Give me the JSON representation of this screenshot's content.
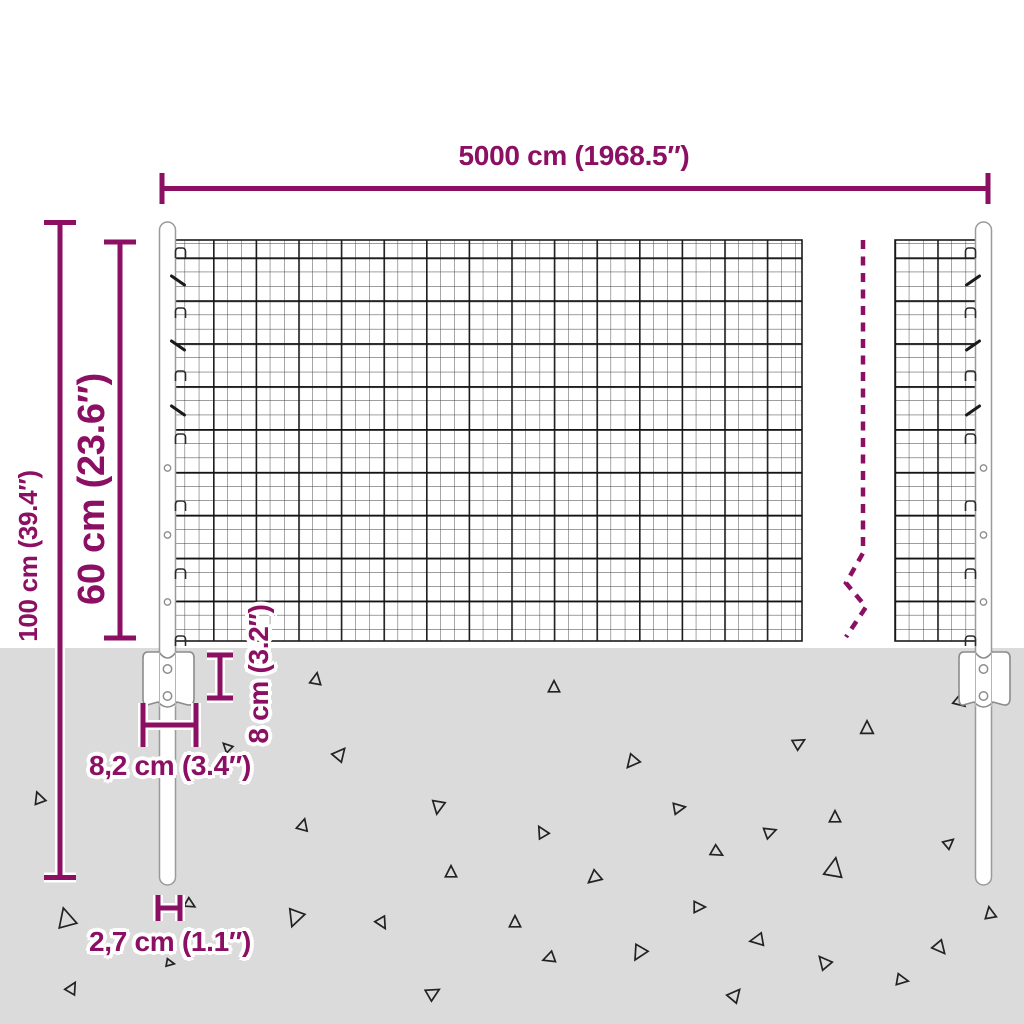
{
  "diagram": {
    "description": "Wire mesh fence with posts - product dimension diagram",
    "dimensions": {
      "total_width": "5000 cm (1968.5″)",
      "total_height": "100 cm (39.4″)",
      "mesh_height": "60 cm (23.6″)",
      "bracket_depth": "8 cm (3.2″)",
      "bracket_width": "8,2 cm (3.4″)",
      "post_diameter": "2,7 cm (1.1″)"
    },
    "colors": {
      "dimension_accent": "#8B0F62",
      "ground": "#DBDBDB",
      "mesh_wire": "#2E2E2E",
      "post_outline": "#9A9A9A",
      "background": "#FFFFFF"
    }
  }
}
